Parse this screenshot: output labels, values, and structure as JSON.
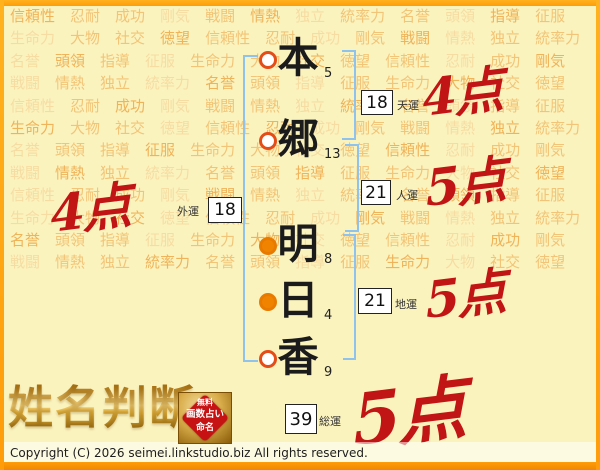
{
  "background": {
    "words": [
      "信頼性",
      "忍耐",
      "成功",
      "剛気",
      "戦闘",
      "情熱",
      "独立",
      "統率力",
      "名誉",
      "頭領",
      "指導",
      "征服",
      "生命力",
      "大物",
      "社交",
      "徳望"
    ],
    "repeat": 9
  },
  "name": {
    "full": "本郷明日香",
    "characters": [
      {
        "char": "本",
        "strokes": "5",
        "marker": "open"
      },
      {
        "char": "郷",
        "strokes": "13",
        "marker": "open"
      },
      {
        "char": "明",
        "strokes": "8",
        "marker": "filled"
      },
      {
        "char": "日",
        "strokes": "4",
        "marker": "filled"
      },
      {
        "char": "香",
        "strokes": "9",
        "marker": "open"
      }
    ]
  },
  "fortunes": {
    "tenun": {
      "label": "天運",
      "value": "18",
      "score": "4点"
    },
    "jinun": {
      "label": "人運",
      "value": "21",
      "score": "5点"
    },
    "gaiun": {
      "label": "外運",
      "value": "18",
      "score": "4点"
    },
    "chiun": {
      "label": "地運",
      "value": "21",
      "score": "5点"
    },
    "soun": {
      "label": "総運",
      "value": "39",
      "score": "5点"
    }
  },
  "footer": {
    "logo": "姓名判断",
    "seal": {
      "line1": "無料",
      "line2": "画数占い",
      "line3": "命名"
    },
    "copyright": "Copyright (C) 2026 seimei.linkstudio.biz All rights reserved."
  },
  "colors": {
    "frame_orange": "#FF9C0A",
    "background_yellow": "#FBF3BE",
    "watermark_orange": "#F0B95E",
    "score_red": "#C11414",
    "bracket_blue": "#8FC3EE",
    "marker_ring": "#E44D18",
    "marker_fill": "#F08300",
    "seal_red": "#C61212",
    "logo_gold": "#E3B23C"
  }
}
